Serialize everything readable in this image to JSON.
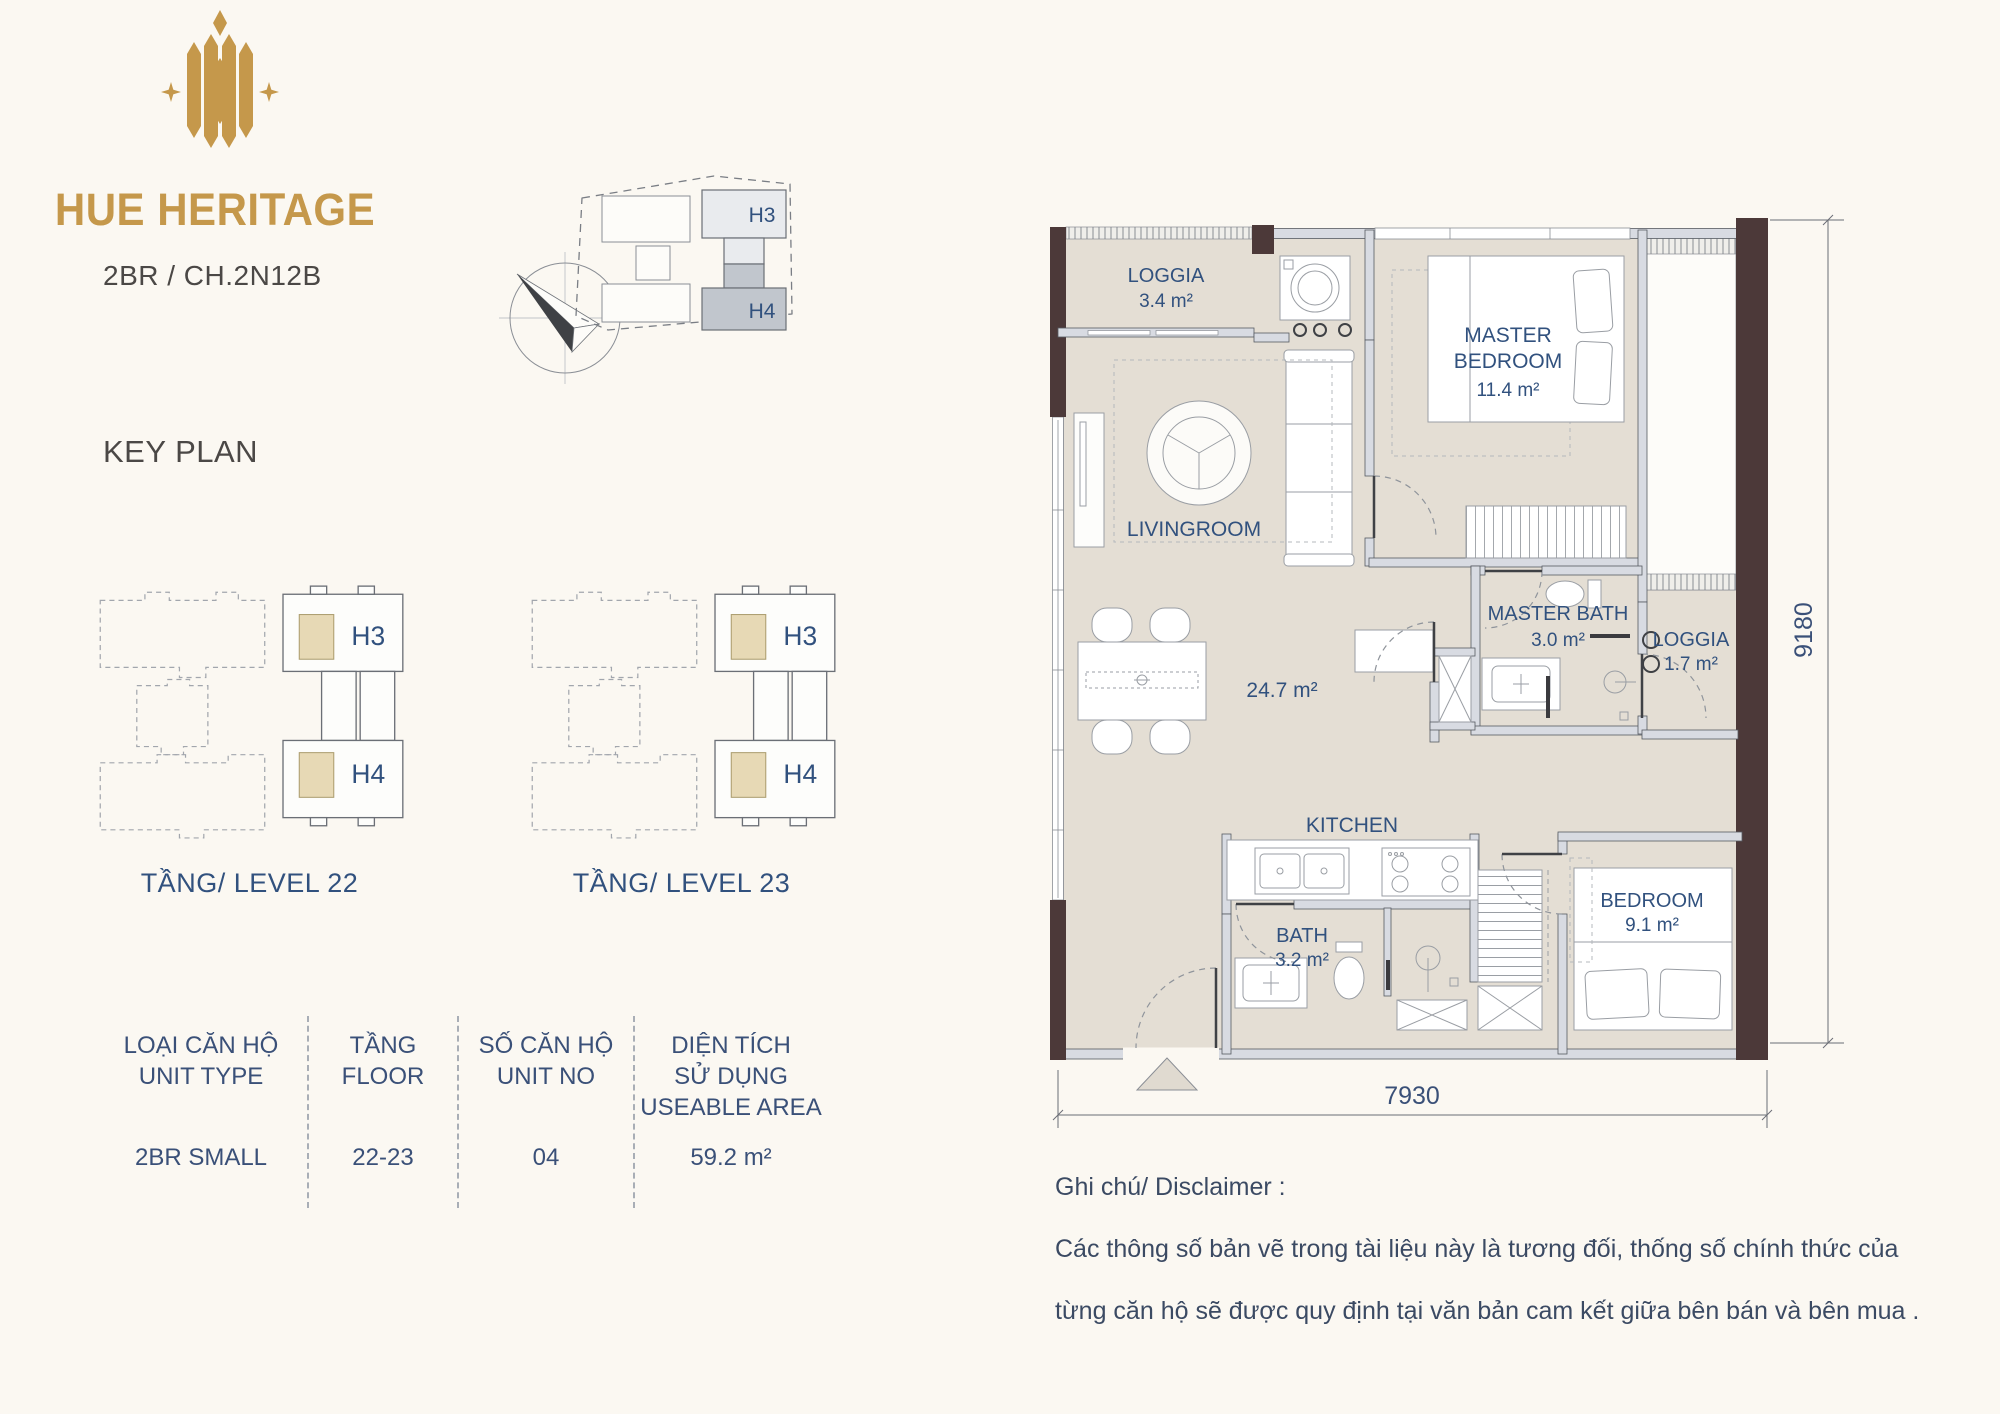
{
  "brand": {
    "name": "HUE HERITAGE",
    "unit_code": "2BR / CH.2N12B",
    "key_plan_title": "KEY PLAN",
    "gold_color": "#C5984B"
  },
  "key_plan": {
    "h3": "H3",
    "h4": "H4"
  },
  "levels": [
    {
      "label": "TẦNG/ LEVEL 22"
    },
    {
      "label": "TẦNG/ LEVEL 23"
    }
  ],
  "unit_table": {
    "columns": [
      {
        "header": [
          "LOẠI CĂN HỘ",
          "UNIT TYPE"
        ],
        "value": "2BR SMALL"
      },
      {
        "header": [
          "TẦNG",
          "FLOOR"
        ],
        "value": "22-23"
      },
      {
        "header": [
          "SỐ CĂN HỘ",
          "UNIT NO"
        ],
        "value": "04"
      },
      {
        "header": [
          "DIỆN TÍCH",
          "SỬ DỤNG",
          "USEABLE AREA"
        ],
        "value": "59.2 m²"
      }
    ]
  },
  "plan": {
    "rooms": {
      "loggia_top": {
        "label": "LOGGIA",
        "area": "3.4 m²"
      },
      "master_bedroom": {
        "line1": "MASTER",
        "line2": "BEDROOM",
        "area": "11.4 m²"
      },
      "livingroom": {
        "label": "LIVINGROOM"
      },
      "living_area": {
        "area": "24.7 m²"
      },
      "master_bath": {
        "label": "MASTER BATH",
        "area": "3.0 m²"
      },
      "loggia_right": {
        "label": "LOGGIA",
        "area": "1.7 m²"
      },
      "kitchen": {
        "label": "KITCHEN"
      },
      "bath": {
        "label": "BATH",
        "area": "3.2 m²"
      },
      "bedroom": {
        "label": "BEDROOM",
        "area": "9.1 m²"
      }
    },
    "dimensions": {
      "bottom": "7930",
      "right": "9180"
    },
    "colors": {
      "floor": "#E4DED4",
      "wall": "#D8DBE2",
      "accent_wall": "#4C3939",
      "label": "#31517E",
      "unit_highlight": "#E7D9B5"
    }
  },
  "disclaimer": {
    "title": "Ghi chú/ Disclaimer :",
    "lines": [
      "Các thông số bản vẽ trong tài liệu này là tương đối, thống số  chính thức của",
      "từng căn hộ sẽ được quy định tại văn bản cam kết giữa bên bán và bên mua ."
    ]
  }
}
